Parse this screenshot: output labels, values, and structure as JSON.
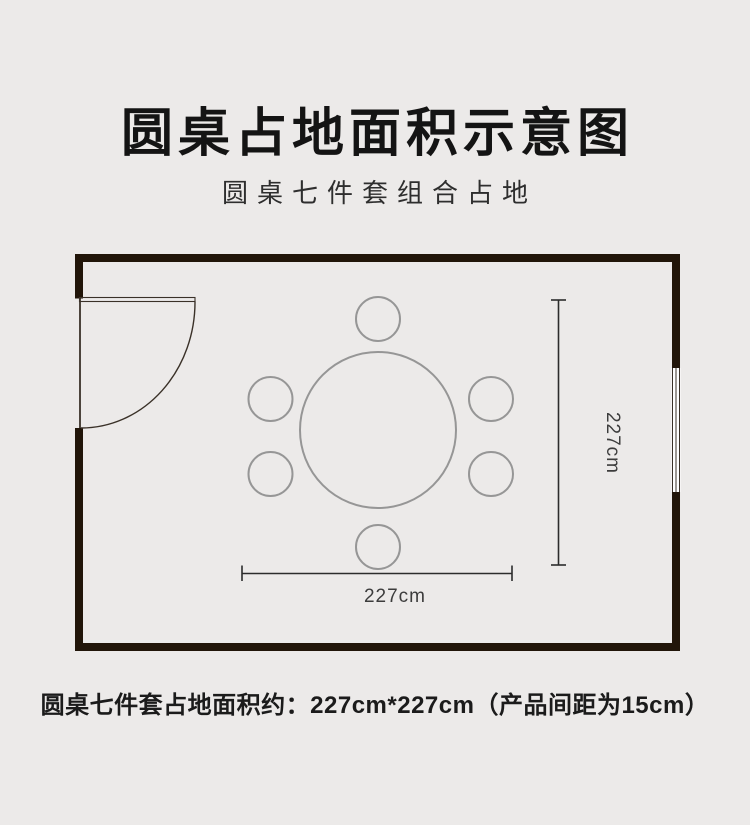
{
  "header": {
    "title": "圆桌占地面积示意图",
    "subtitle": "圆桌七件套组合占地"
  },
  "floorplan": {
    "width_label": "227cm",
    "height_label": "227cm",
    "furniture": {
      "table": "round-dining-table",
      "chair_count": 6,
      "door": "hinged-door-left-wall",
      "window": "window-right-wall"
    },
    "colors": {
      "background": "#ECEAE9",
      "wall": "#211509",
      "door_line": "#3A3128",
      "furniture_stroke": "#969696",
      "dimension_line": "#2C2C2C",
      "dimension_text": "#3C3C3C"
    }
  },
  "caption": {
    "text": "圆桌七件套占地面积约：227cm*227cm（产品间距为15cm）"
  }
}
